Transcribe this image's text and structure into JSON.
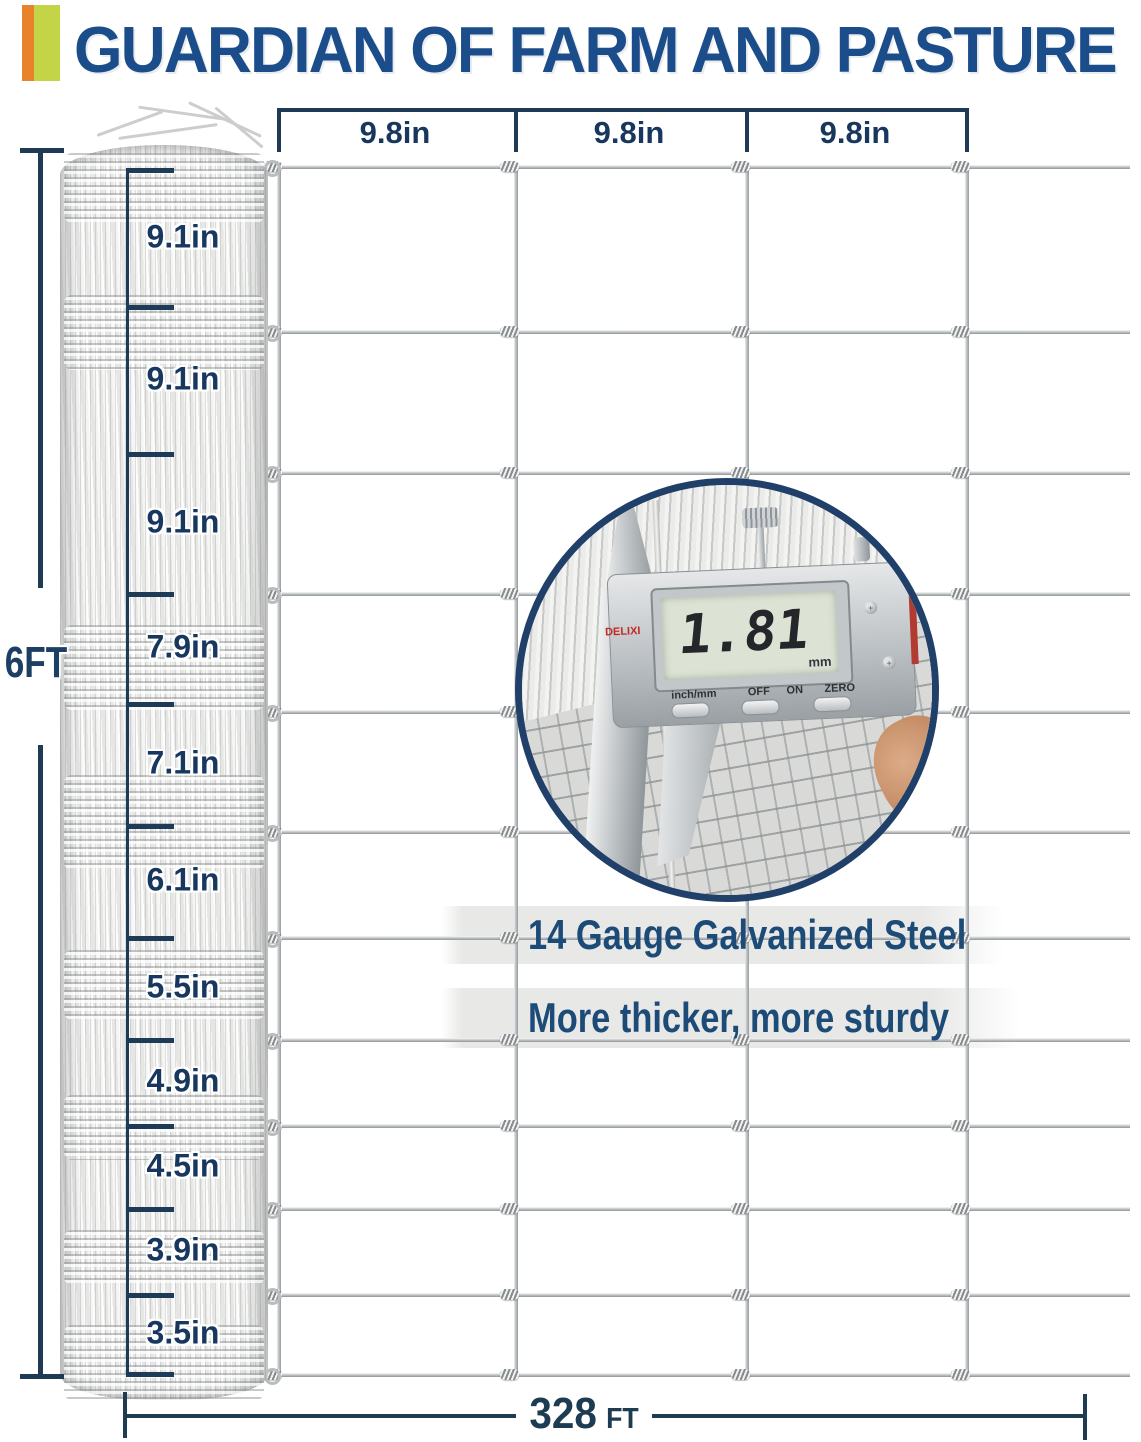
{
  "title": "GUARDIAN OF FARM AND PASTURE",
  "colors": {
    "accent_orange": "#e8832c",
    "accent_green": "#c3d546",
    "title_navy": "#1b4d8b",
    "dimension_navy": "#1d3f63",
    "ring_navy": "#204069",
    "wire_gray": "#b9bdbf"
  },
  "top_dimension": {
    "labels": [
      "9.8in",
      "9.8in",
      "9.8in"
    ]
  },
  "height_dimension": {
    "label": "6FT"
  },
  "roll_spacing_labels": [
    "9.1in",
    "9.1in",
    "9.1in",
    "7.9in",
    "7.1in",
    "6.1in",
    "5.5in",
    "4.9in",
    "4.5in",
    "3.9in",
    "3.5in"
  ],
  "length_dimension": {
    "value": "328",
    "unit": "FT"
  },
  "features": {
    "line1": "14 Gauge Galvanized Steel",
    "line2": "More thicker, more sturdy"
  },
  "inset": {
    "display_value": "1.81",
    "display_unit": "mm",
    "brand": "DELIXI",
    "button_labels": [
      "inch/mm",
      "OFF",
      "ON",
      "ZERO"
    ]
  }
}
